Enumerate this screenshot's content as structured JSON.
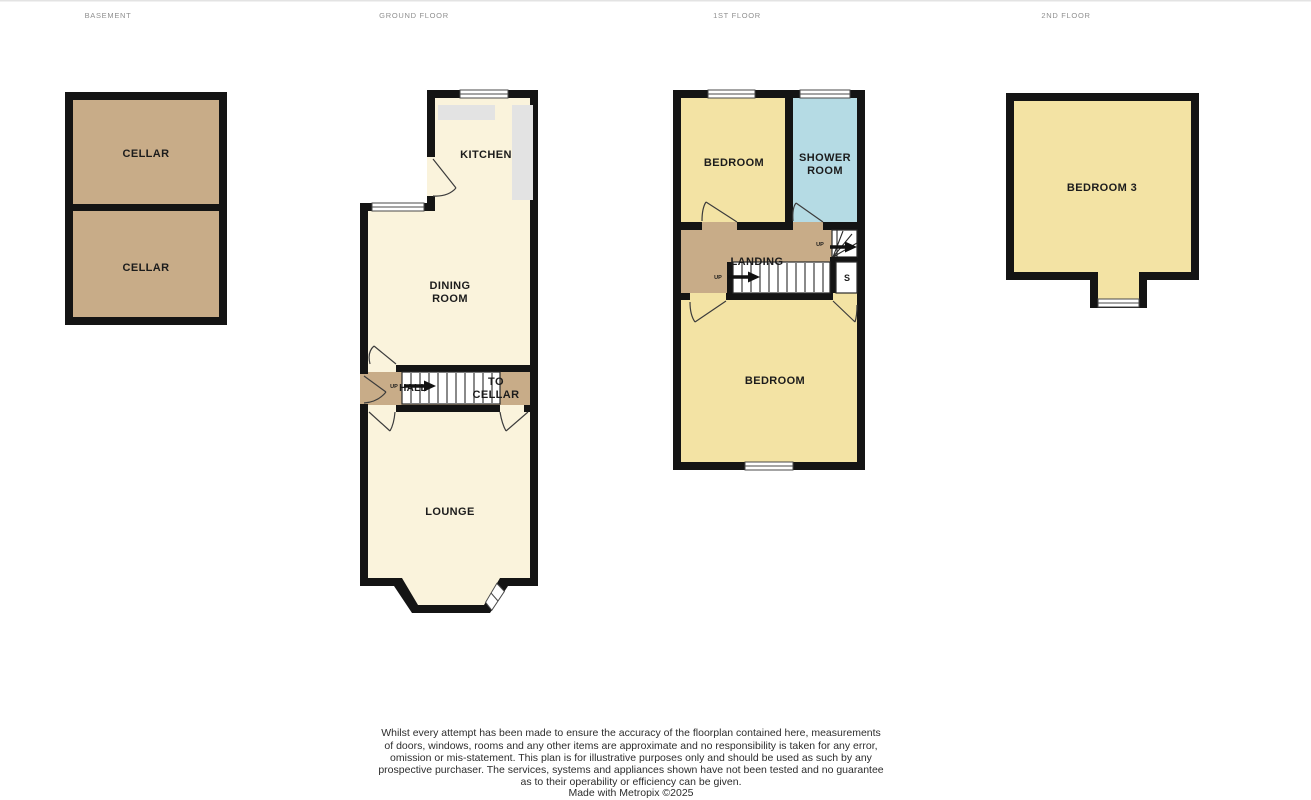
{
  "page": {
    "background": "#ffffff"
  },
  "floor_headers": {
    "basement": "BASEMENT",
    "ground": "GROUND FLOOR",
    "first": "1ST FLOOR",
    "second": "2ND FLOOR"
  },
  "rooms": {
    "cellar_upper": "CELLAR",
    "cellar_lower": "CELLAR",
    "kitchen": "KITCHEN",
    "dining_line1": "DINING",
    "dining_line2": "ROOM",
    "hall": "HALL",
    "hall_up": "UP",
    "to_cellar_line1": "TO",
    "to_cellar_line2": "CELLAR",
    "lounge": "LOUNGE",
    "bedroom_front": "BEDROOM",
    "shower_line1": "SHOWER",
    "shower_line2": "ROOM",
    "landing": "LANDING",
    "landing_up": "UP",
    "winder_up": "UP",
    "store_cupboard": "S",
    "bedroom_back": "BEDROOM",
    "bedroom3": "BEDROOM 3"
  },
  "footer": {
    "lines": [
      "Whilst every attempt has been made to ensure the accuracy of the floorplan contained here, measurements",
      "of doors, windows, rooms and any other items are approximate and no responsibility is taken for any error,",
      "omission or mis-statement. This plan is for illustrative purposes only and should be used as such by any",
      "prospective purchaser. The services, systems and appliances shown have not been tested and no guarantee",
      "as to their operability or efficiency can be given.",
      "Made with Metropix ©2025"
    ]
  },
  "colors": {
    "wall": "#141414",
    "room_cream": "#faf3dc",
    "room_tan": "#c8ac88",
    "room_yellow": "#f3e3a4",
    "room_blue": "#b5dbe4",
    "counter_grey": "#e3e3e3",
    "header_text": "#8f8f8f",
    "label_text": "#1c1c1c",
    "footer_text": "#2d2d2d"
  }
}
